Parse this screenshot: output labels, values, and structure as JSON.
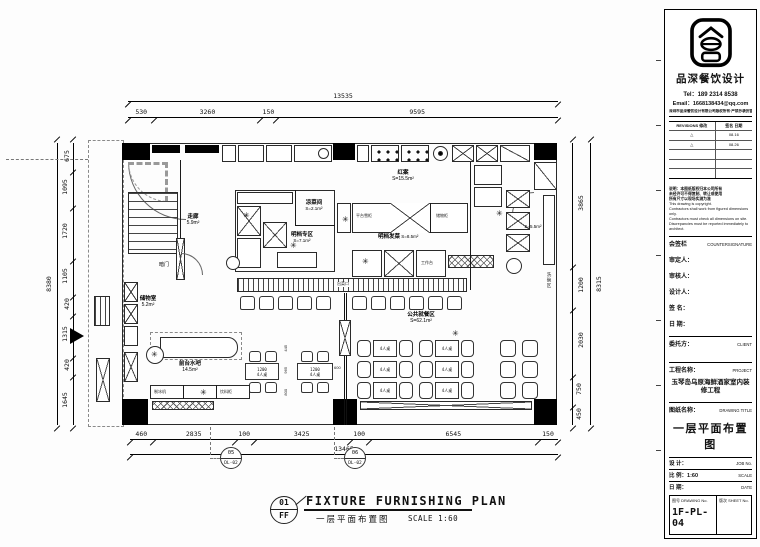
{
  "plan": {
    "dims": {
      "top_total": "13535",
      "top": [
        "530",
        "3260",
        "150",
        "9595"
      ],
      "left_total": "8380",
      "left": [
        "675",
        "1095",
        "1720",
        "1105",
        "420",
        "1315",
        "420",
        "1645"
      ],
      "right_total": "8315",
      "right": [
        "3865",
        "1200",
        "2030",
        "750",
        "450"
      ],
      "bottom_total": "13465",
      "bottom": [
        "460",
        "2835",
        "100",
        "3425",
        "100",
        "6545",
        "150"
      ]
    },
    "rooms": {
      "corridor": "走廊",
      "corridor_area": "5.9m²",
      "storage": "储物室",
      "storage_area": "5.2m²",
      "hidden_door": "暗门",
      "cold_dish": "凉菜间",
      "cold_dish_area": "S=2.1m²",
      "open_counter": "明档专区",
      "open_counter_area": "S=7.1m²",
      "hot_kitchen": "红案",
      "hot_kitchen_area": "S=15.5m²",
      "pass": "明档发菜",
      "pass_area": "S=8.5m²",
      "dishwash": "洗碗区",
      "dishwash_area": "S=5.5m²",
      "dining": "公共就餐区",
      "dining_area": "S=62.1m²",
      "bar": "前台水吧",
      "bar_area": "14.5m²"
    },
    "equipment": {
      "platform_fridge": "平台雪柜",
      "storage_cab": "储物柜",
      "worktable": "工作台",
      "pass_label": "出菜口",
      "ice_maker": "制冰机",
      "drink_fridge": "饮料柜"
    },
    "furniture": {
      "table_w": "1200",
      "table_label": "4人桌",
      "dim_965": "965",
      "dim_600": "600",
      "dim_445": "445",
      "dim_800": "800"
    },
    "markers": {
      "m1_top": "05",
      "m1_bot": "DL-02",
      "m2_top": "06",
      "m2_bot": "DL-02"
    }
  },
  "caption": {
    "num": "01",
    "code": "FF",
    "title_en": "FIXTURE FURNISHING PLAN",
    "title_cn": "一层平面布置图",
    "scale": "SCALE 1:60"
  },
  "titleblock": {
    "brand": "品深餐饮设计",
    "tel": "Tel：189 2314 8538",
    "email": "Email：1668138434@qq.com",
    "copyright": "深圳市品深餐饮设计有限公司版权所有·严禁抄袭仿冒违者必究",
    "rev_head_l": "REVISIONS 修改",
    "rev_head_r": "签名 日期",
    "revisions": [
      {
        "mark": "△",
        "date": "08.16"
      },
      {
        "mark": "△",
        "date": "08.26"
      }
    ],
    "notes_cn": [
      "说明：本图纸版权归本公司所有",
      "未经许可不得复制、转让或使用",
      "所有尺寸以现场实测为准"
    ],
    "notes_en": [
      "This drawing is copyright.",
      "Contractors shall work from figured dimensions only.",
      "Contractors must check all dimensions on site.",
      "Discrepancies must be reported immediately to architect."
    ],
    "countersign_cn": "会签栏",
    "countersign_en": "COUNTERSIGNATURE",
    "fields": [
      "审定人：",
      "审核人：",
      "设计人：",
      "签  名：",
      "日  期："
    ],
    "client_label": "委托方：",
    "client_en": "CLIENT",
    "project_label": "工程名称：",
    "project_en": "PROJECT",
    "project_name": "玉琴岛乌原海鲜酒家室内装修工程",
    "drawing_label": "图纸名称：",
    "drawing_en": "DRAWING TITLE",
    "drawing_name": "一层平面布置图",
    "job_label": "设 计：",
    "job_en": "JOB No.",
    "scale_label": "比 例：1:60",
    "scale_en": "SCALE",
    "date_label": "日 期：",
    "date_en": "DATE",
    "dwg_label": "图号 DRAWING No.",
    "dwg_no": "1F-PL-04",
    "sheet_label": "版次 SHEET No."
  }
}
